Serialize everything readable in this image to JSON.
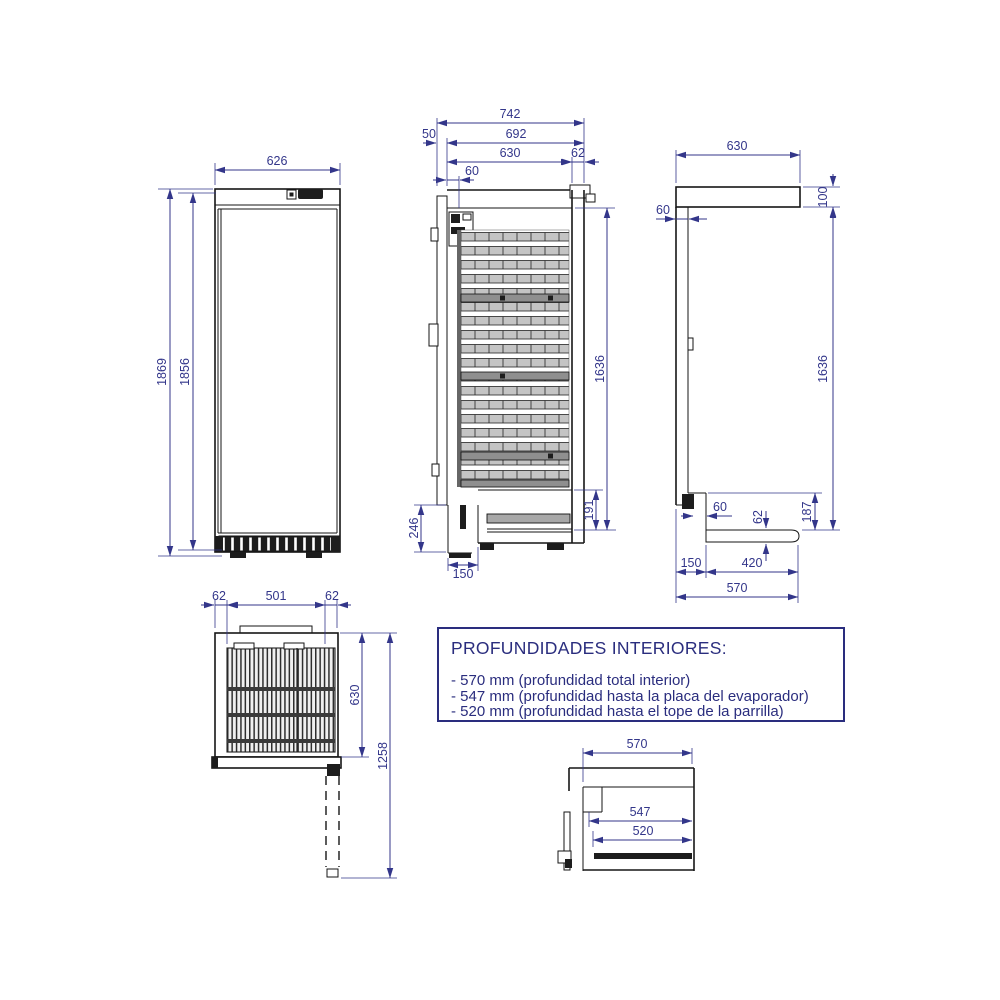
{
  "document": {
    "type": "technical-drawing",
    "subject": "upright refrigerator dimensional views",
    "units": "mm",
    "colors": {
      "dimension": "#33368a",
      "outline": "#161616",
      "notes_border": "#2a2d7e"
    }
  },
  "views": {
    "front": {
      "width": "626",
      "height_total": "1869",
      "height_body": "1856"
    },
    "section": {
      "depth_total": "742",
      "depth_no_door": "692",
      "interior_depth": "630",
      "back_wall": "62",
      "door_thickness": "50",
      "evap_offset": "60",
      "interior_height": "1636",
      "bottom_compartment": "191",
      "plinth_height": "246",
      "plinth_depth": "150"
    },
    "side": {
      "top_depth": "630",
      "top_height": "100",
      "wall_thickness": "60",
      "interior_height": "1636",
      "step_height": "187",
      "shelf_thickness": "62",
      "step_offset": "60",
      "base_front": "150",
      "base_back": "420",
      "base_total": "570"
    },
    "top": {
      "wall_left": "62",
      "interior_width": "501",
      "wall_right": "62",
      "depth": "630",
      "depth_door_open": "1258"
    },
    "detail": {
      "total_interior": "570",
      "to_evaporator": "547",
      "to_grid": "520"
    }
  },
  "notes": {
    "title": "PROFUNDIDADES INTERIORES:",
    "lines": [
      "- 570 mm (profundidad total interior)",
      "- 547 mm (profundidad hasta la placa del evaporador)",
      "- 520 mm (profundidad hasta el tope de la parrilla)"
    ]
  }
}
